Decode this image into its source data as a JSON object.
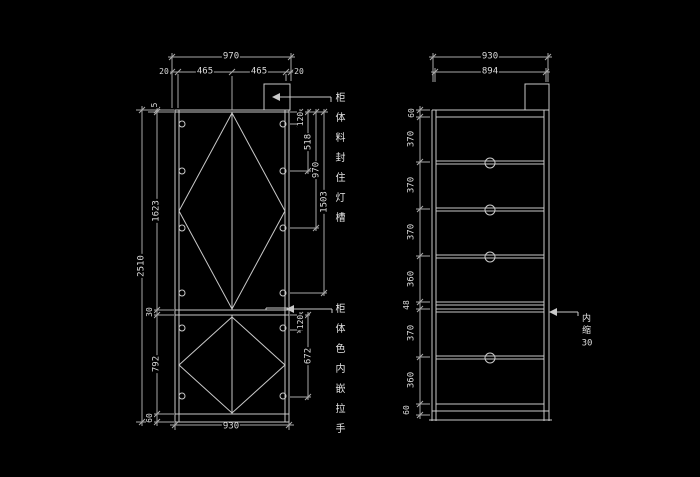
{
  "drawing": {
    "type": "cad-cabinet-elevation",
    "colors": {
      "background": "#000000",
      "line": "#c9c9c9",
      "dim_line": "#a8a8a8",
      "text": "#dcdcdc"
    },
    "front_view": {
      "dims": {
        "overall_width": "970",
        "width_segments": [
          "20",
          "465",
          "465",
          "20"
        ],
        "overall_height": "2510",
        "height_chain": [
          "5",
          "1623",
          "30",
          "792",
          "60"
        ],
        "upper_hole_offsets": [
          "120",
          "518",
          "970",
          "1503"
        ],
        "lower_hole_offsets": [
          "120",
          "672"
        ],
        "bottom_width": "930"
      },
      "notes": {
        "light_trough": "柜体料封住灯槽",
        "handle": "柜体色内嵌拉手"
      }
    },
    "side_view": {
      "dims": {
        "overall_width": "930",
        "inner_width": "894",
        "height_chain": [
          "60",
          "370",
          "370",
          "370",
          "360",
          "48",
          "370",
          "360",
          "60"
        ]
      },
      "notes": {
        "inset_label": "内缩",
        "inset_value": "30"
      }
    }
  }
}
